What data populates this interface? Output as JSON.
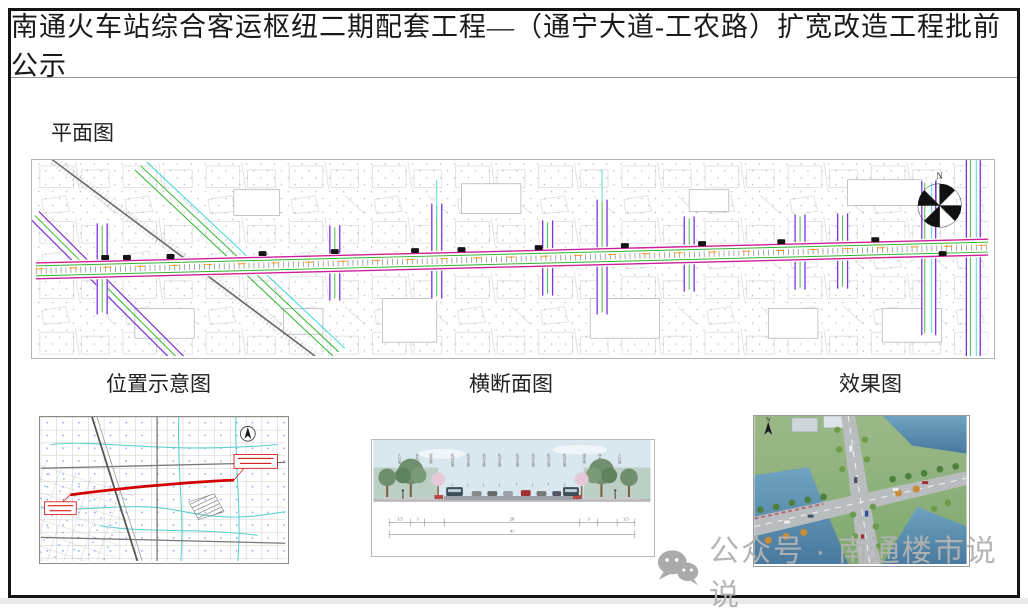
{
  "page": {
    "title": "南通火车站综合客运枢纽二期配套工程—（通宁大道-工农路）扩宽改造工程批前公示"
  },
  "plan": {
    "label": "平面图",
    "north_label": "N"
  },
  "figures": {
    "location": {
      "label": "位置示意图"
    },
    "cross_section": {
      "label": "横断面图",
      "lane_labels": [
        "人行道",
        "非机动车道",
        "绿化带",
        "机动车道",
        "机动车道",
        "机动车道",
        "机动车道",
        "机动车道",
        "机动车道",
        "机动车道",
        "机动车道",
        "绿化带",
        "非机动车道",
        "人行道"
      ],
      "arrow_down": "↓",
      "arrow_up": "↑",
      "dimensions": {
        "seg1": "3.5",
        "seg2": "3",
        "seg3": "28",
        "seg4": "3",
        "seg5": "3.5",
        "total": "41"
      }
    },
    "rendering": {
      "label": "效果图",
      "north_label": "N"
    }
  },
  "watermark": {
    "text": "公众号 · 南通楼市说说"
  },
  "colors": {
    "road_magenta": "#cf1f9b",
    "road_green": "#2fb52f",
    "road_purple": "#7a2fe0",
    "road_cyan": "#3fd6d6",
    "route_red": "#d40000",
    "water_blue": "#4f86a8",
    "sky_blue": "#d9e7ef",
    "watermark_gray": "#b3b3b3"
  }
}
